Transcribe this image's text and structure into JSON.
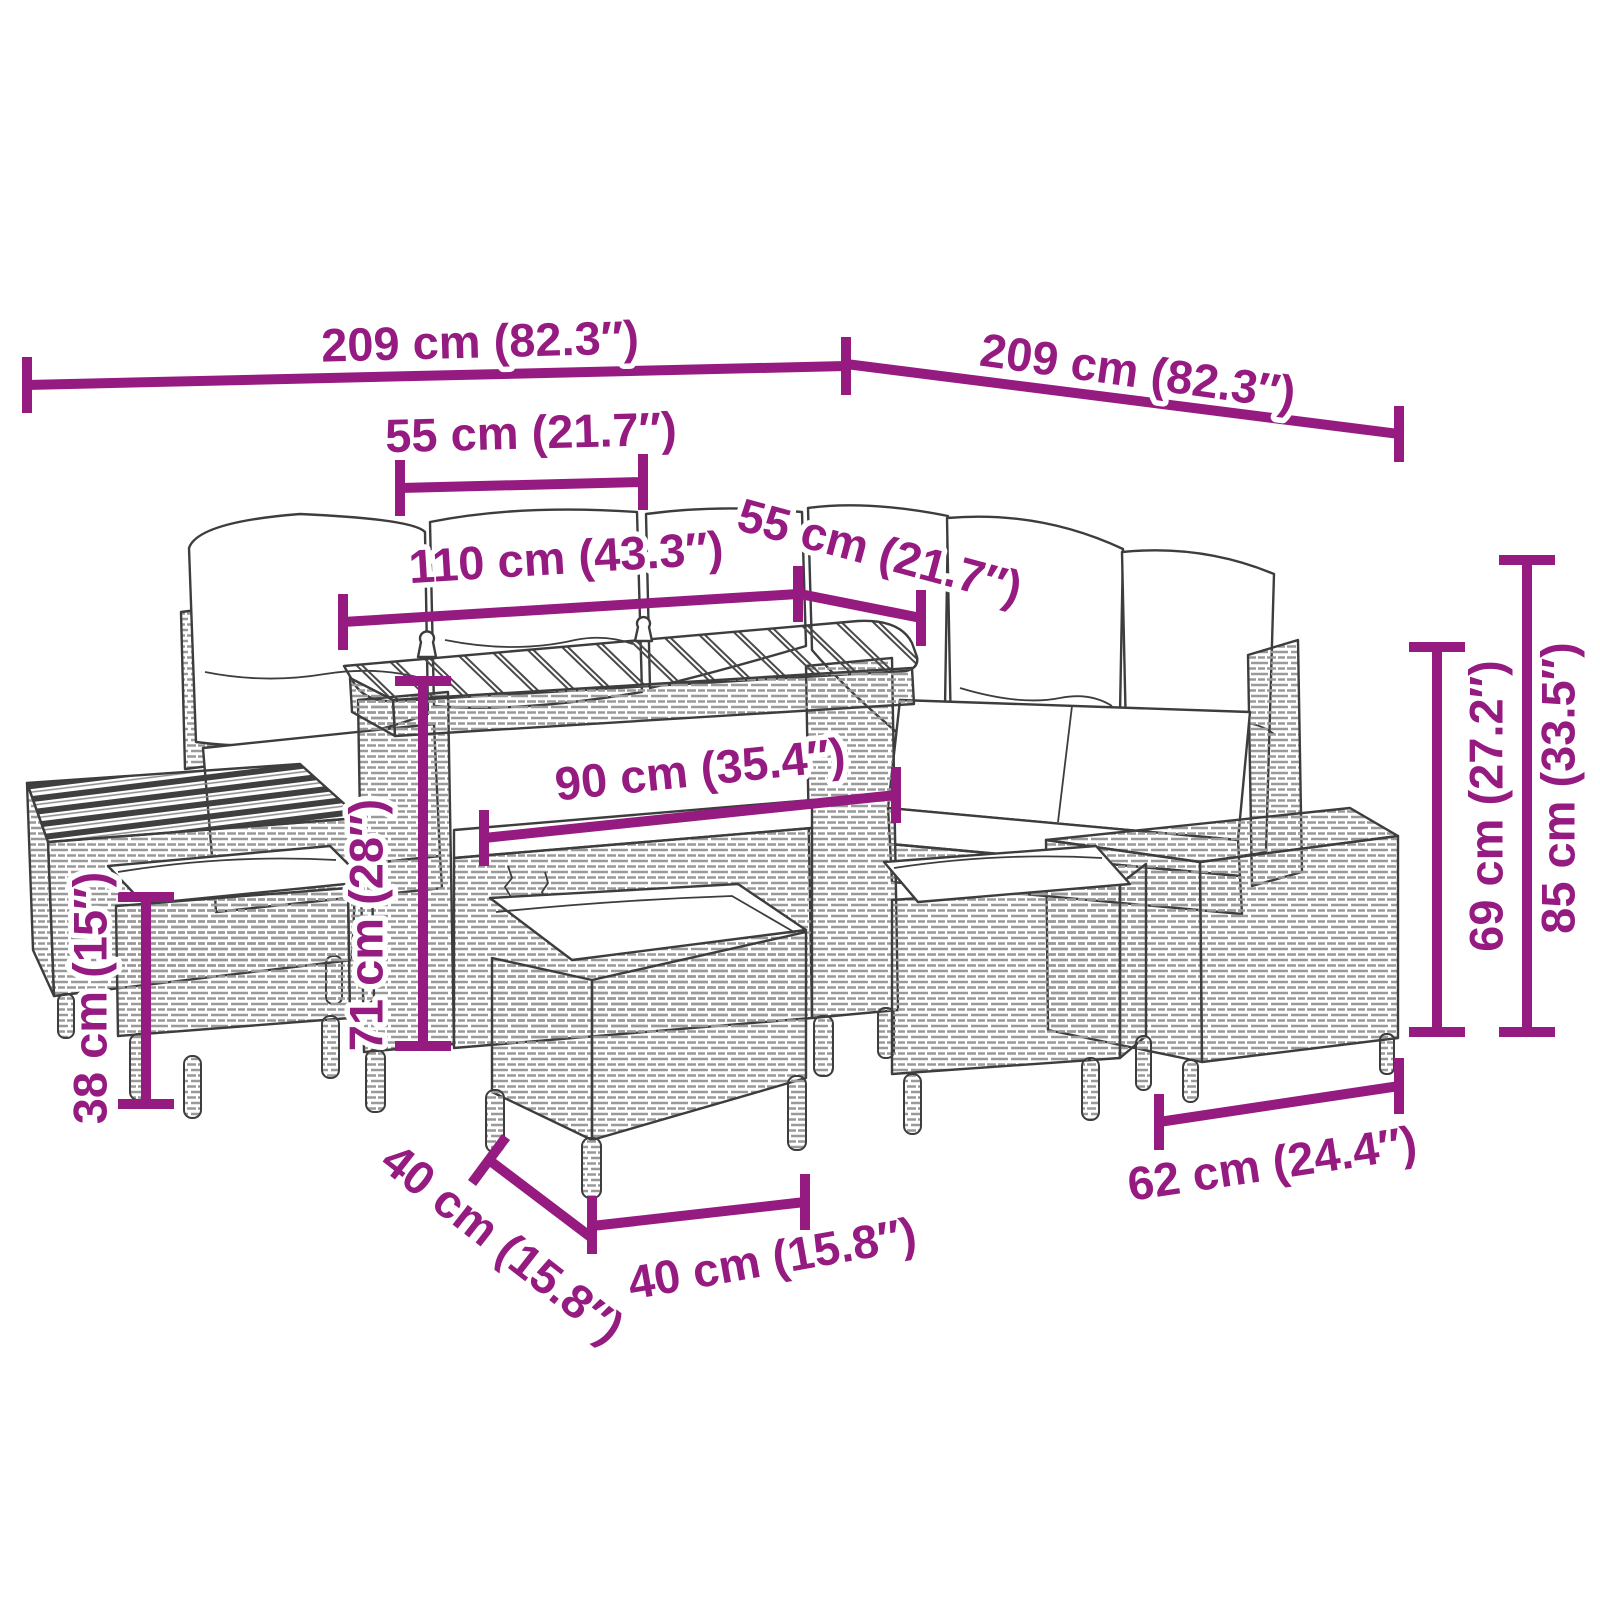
{
  "colors": {
    "accent": "#951B81",
    "outline": "#3D3D3D",
    "weave": "#9A9A9A",
    "background": "#FFFFFF"
  },
  "product": {
    "kind": "garden-lounge-set-dimension-diagram"
  },
  "dimensions": {
    "sofa_left_length": {
      "label": "209 cm (82.3″)"
    },
    "sofa_right_length": {
      "label": "209 cm (82.3″)"
    },
    "seat_depth_left": {
      "label": "55 cm (21.7″)"
    },
    "table_length": {
      "label": "110 cm (43.3″)"
    },
    "seat_depth_right": {
      "label": "55 cm (21.7″)"
    },
    "table_base_width": {
      "label": "90 cm (35.4″)"
    },
    "table_height": {
      "label": "71 cm (28″)"
    },
    "stool_height": {
      "label": "38 cm (15″)"
    },
    "stool_depth": {
      "label": "40 cm (15.8″)"
    },
    "stool_width": {
      "label": "40 cm (15.8″)"
    },
    "side_table_width": {
      "label": "62 cm (24.4″)"
    },
    "armrest_height": {
      "label": "69 cm (27.2″)"
    },
    "total_height": {
      "label": "85 cm (33.5″)"
    }
  }
}
